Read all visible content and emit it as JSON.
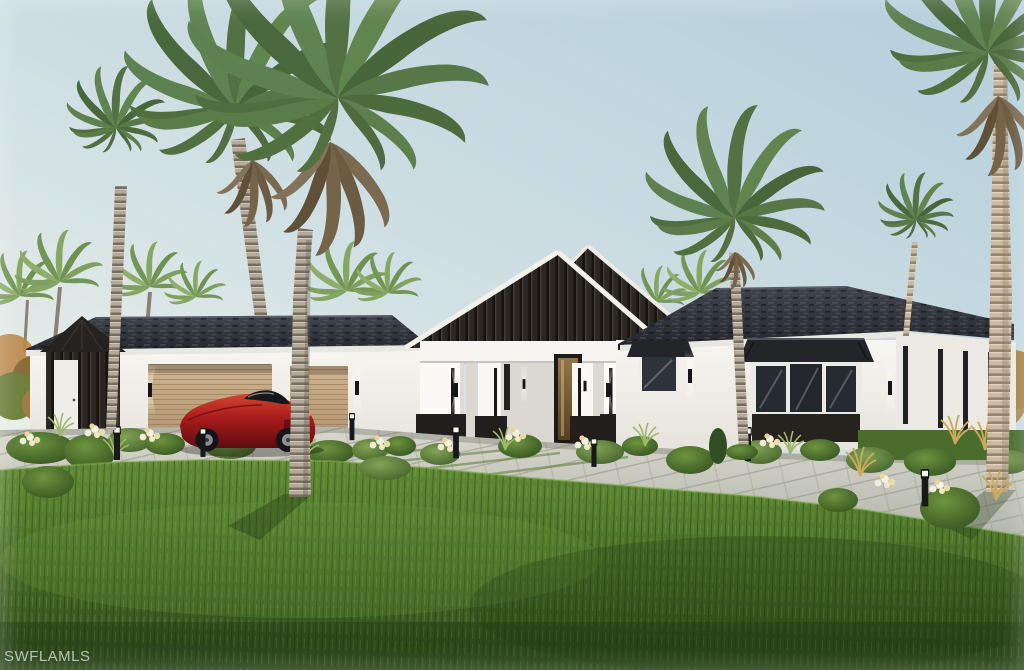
{
  "image": {
    "type": "architectural-rendering",
    "subject": "Single-story modern coastal home with dark gable roofs, white walls, tan double garage, red sports car on paver driveway, tall palm trees and landscaped lawn",
    "width_px": 1024,
    "height_px": 670
  },
  "watermark": {
    "text": "SWFLAMLS",
    "color": "#d3d2cd"
  },
  "palette": {
    "sky_top": "#b7d0dc",
    "sky_horizon": "#eef1ea",
    "roof_dark": "#2c3036",
    "gable_siding": "#2b2724",
    "wall_white": "#f5f3ee",
    "trim_white": "#edebe6",
    "garage_door_tan": "#c4a87f",
    "driveway_gray": "#cdccc3",
    "lawn_green": "#4c7430",
    "lawn_shadow": "#2f4c1c",
    "palm_green": "#57784a",
    "palm_dead_brown": "#77674d",
    "trunk_gray": "#b3aa9b",
    "trunk_tan": "#cbbba5",
    "car_red": "#a81b1b",
    "window_glass": "#262b31"
  },
  "scene": {
    "elements": [
      "sky",
      "background-trees",
      "house",
      "garage-wing",
      "garage-doors",
      "side-entry-door",
      "entry-portico",
      "front-door",
      "right-wing",
      "bay-window",
      "picture-window",
      "wall-sconces",
      "path-lights",
      "paver-driveway",
      "entry-walkway",
      "front-lawn",
      "landscaping",
      "red-sports-car",
      "foreground-palm-trees",
      "watermark"
    ],
    "garage_door_count": 2,
    "path_light_count": 7
  }
}
